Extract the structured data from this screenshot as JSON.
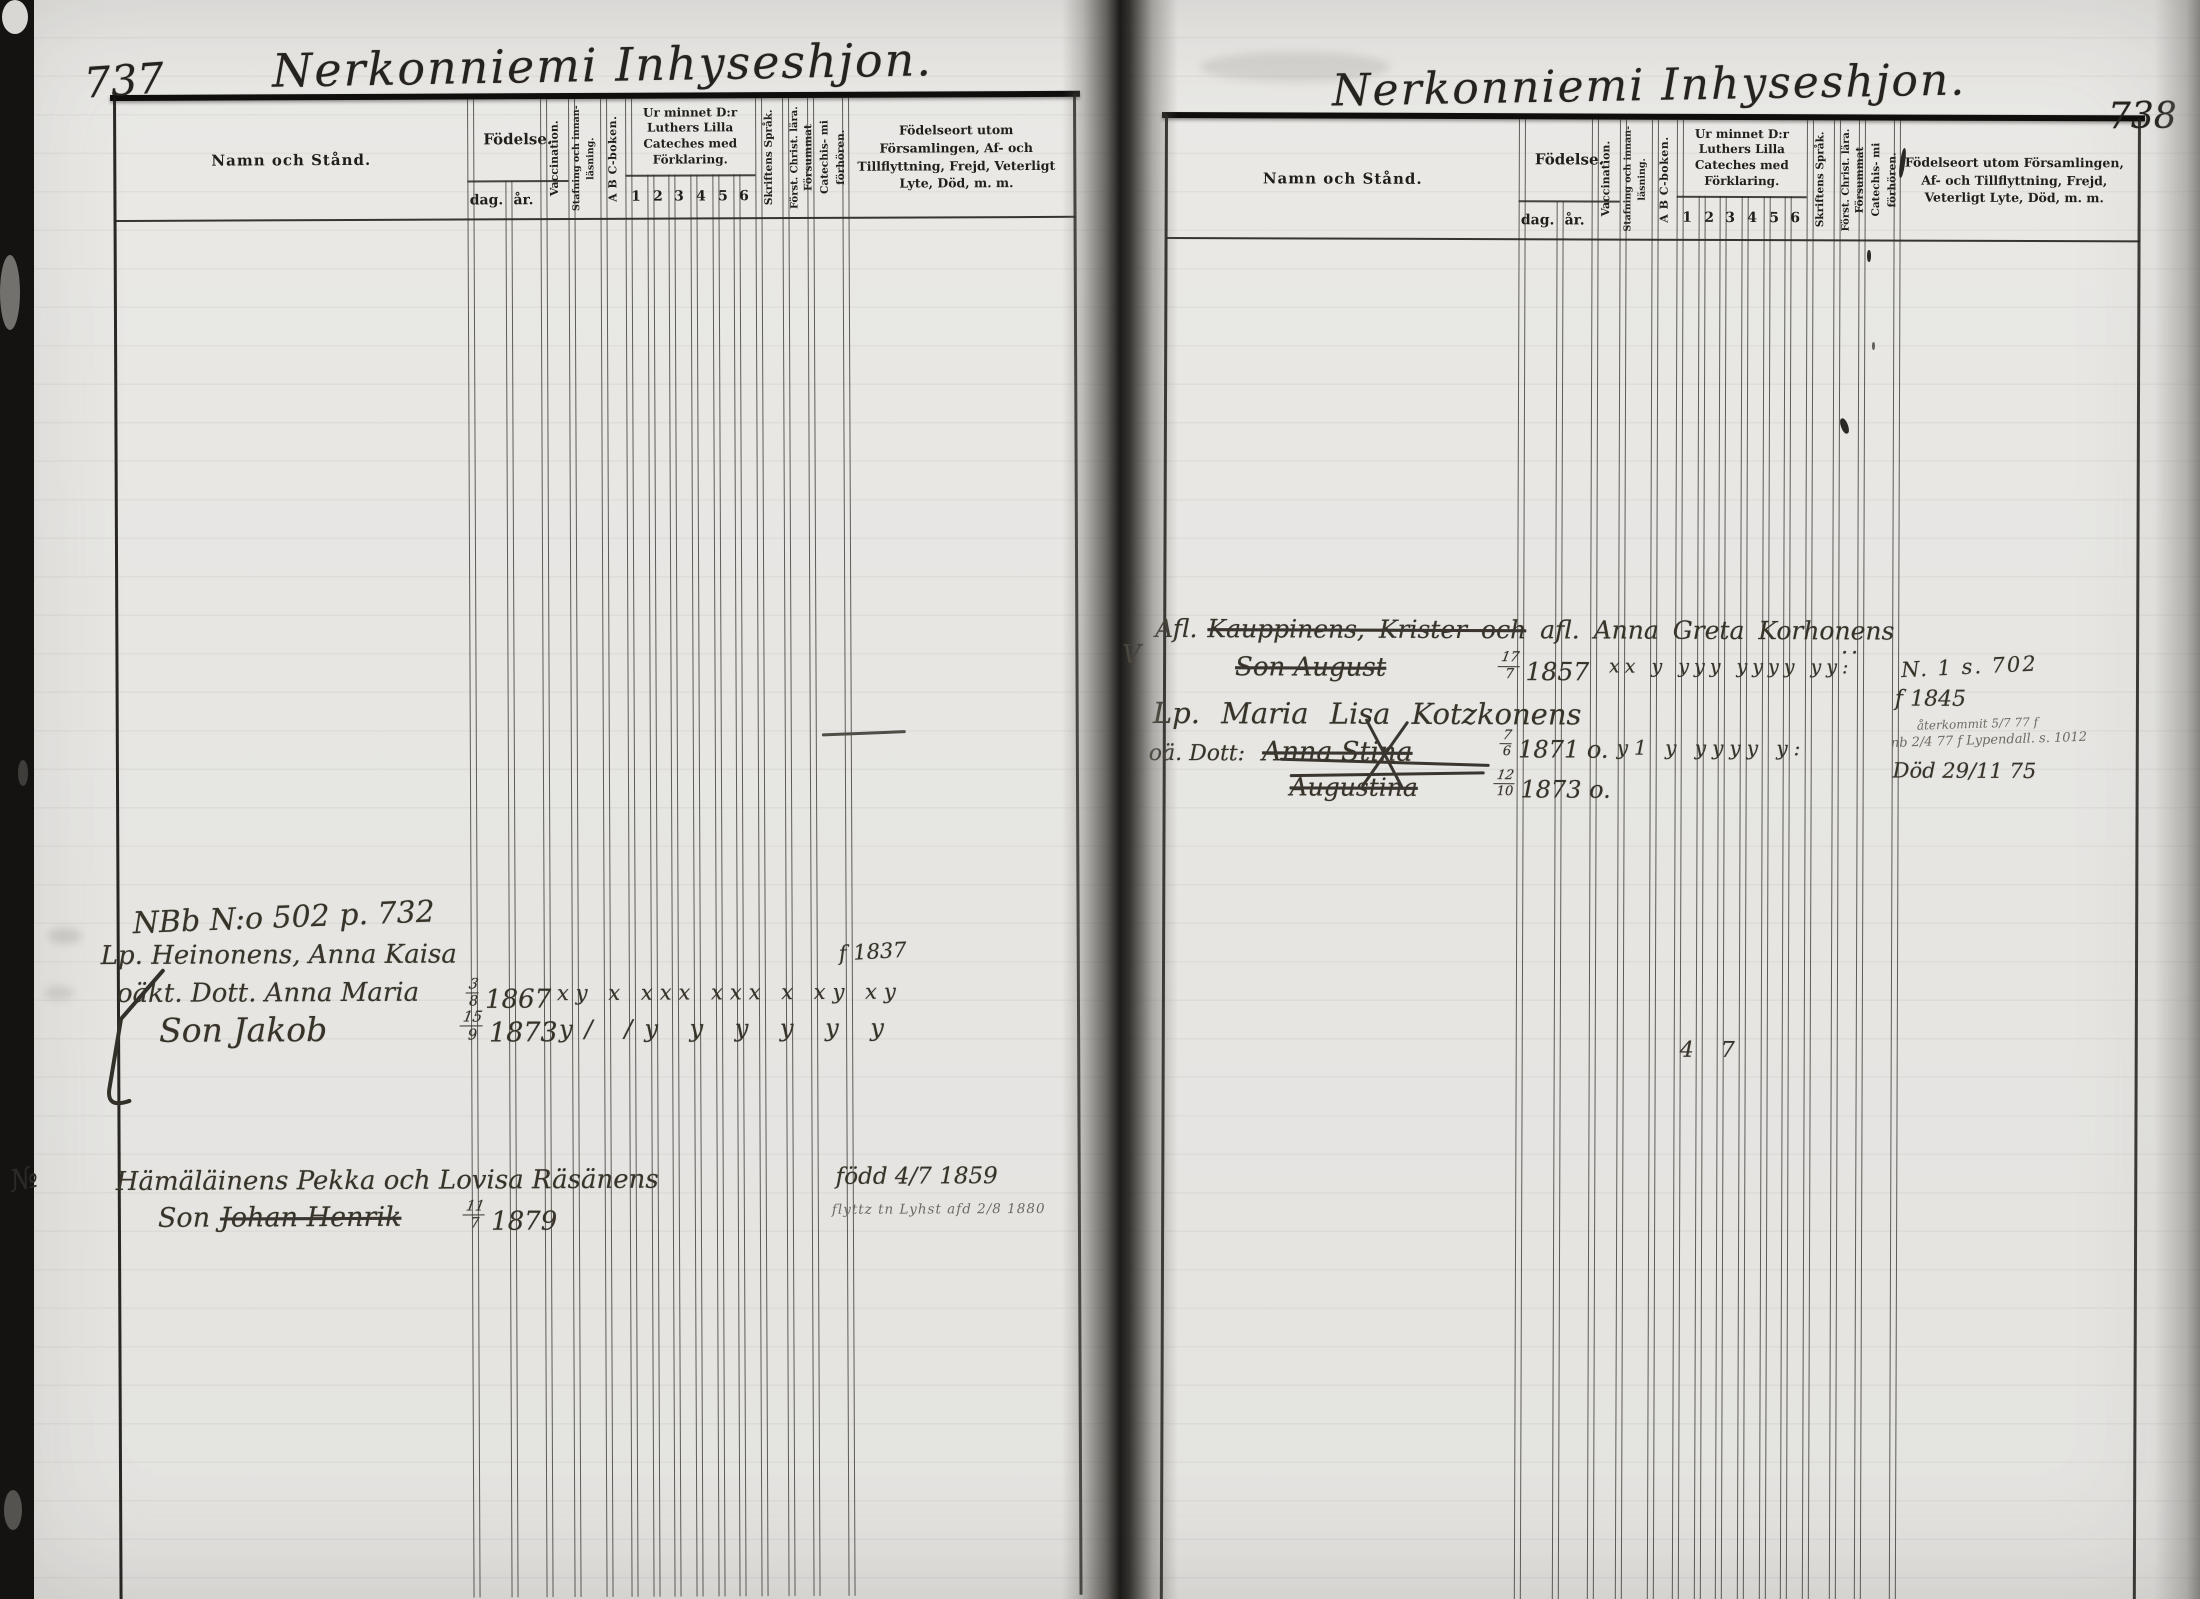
{
  "colors": {
    "paper": "#e8e7e4",
    "print_ink": "#211f1c",
    "handwriting_ink": "#373329",
    "table_line": "#302d29",
    "gutter_shadow": "#121010"
  },
  "header": {
    "namn": "Namn och Stånd.",
    "fodelse": "Födelse.",
    "dag": "dag.",
    "ar": "år.",
    "vaccination": "Vaccination.",
    "stafning": "Stafning och innan- läsning.",
    "abc": "A B C-boken.",
    "cateches": "Ur minnet D:r Luthers Lilla Cateches med Förklaring.",
    "nums": [
      "1",
      "2",
      "3",
      "4",
      "5",
      "6"
    ],
    "skriftens": "Skriftens Språk.",
    "forst": "Först. Christ. lära.",
    "forsummat": "Försummat Catechis- mi förhören.",
    "fodelseort": "Födelseort utom Församlingen, Af- och Tillflyttning, Frejd, Veterligt Lyte, Död, m. m."
  },
  "left": {
    "page_number": "737",
    "title": "Nerkonniemi Inhyseshjon.",
    "margin_mark": "№",
    "e1": {
      "ref": "NBb N:o 502 p. 732",
      "line1": "Lp. Heinonens, Anna Kaisa",
      "line2": "oäkt. Dott. Anna Maria",
      "line3": "Son Jakob",
      "d1_top": "3",
      "d1_bot": "8",
      "d1_year": "1867",
      "d2_top": "15",
      "d2_bot": "9",
      "d2_year": "1873",
      "marks1": "xy x xxx xxx x xy xy",
      "marks2": "y/ /y y y y y y",
      "note": "f 1837"
    },
    "e2": {
      "line1": "Hämäläinens Pekka och Lovisa Räsänens",
      "line2_prefix": "Son",
      "line2_struck": "Johan Henrik",
      "d_top": "11",
      "d_bot": "7",
      "d_year": "1879",
      "note1": "född 4/7 1859",
      "note2": "flyttz tn Lyhst afd 2/8 1880"
    }
  },
  "right": {
    "page_number": "738",
    "title": "Nerkonniemi Inhyseshjon.",
    "margin_mark": "V",
    "stray_marks": "4 7",
    "r1": {
      "prefix": "Afl.",
      "struck": "Kauppinens, Krister och",
      "rest": "afl. Anna Greta Korhonens",
      "trail": ".."
    },
    "r2": {
      "struck": "Son August",
      "d_top": "17",
      "d_bot": "7",
      "d_year": "1857",
      "marks": "xx y yyy yyyy yy:"
    },
    "r3": {
      "line": "Lp. Maria Lisa Kotzkonens"
    },
    "r4": {
      "prefix": "oä. Dott:",
      "struck": "Anna Stina",
      "d_top": "7",
      "d_bot": "6",
      "d_year": "1871 o.",
      "marks": "y1 y yyyy y:"
    },
    "r5": {
      "struck": "Augustina",
      "d_top": "12",
      "d_bot": "10",
      "d_year": "1873 o."
    },
    "notes": {
      "n1": "N. 1 s. 702",
      "n2": "f 1845",
      "n3": "återkommit 5/7 77 f",
      "n4": "nb 2/4 77 f Lypendall. s. 1012",
      "n5": "Död 29/11 75"
    }
  }
}
